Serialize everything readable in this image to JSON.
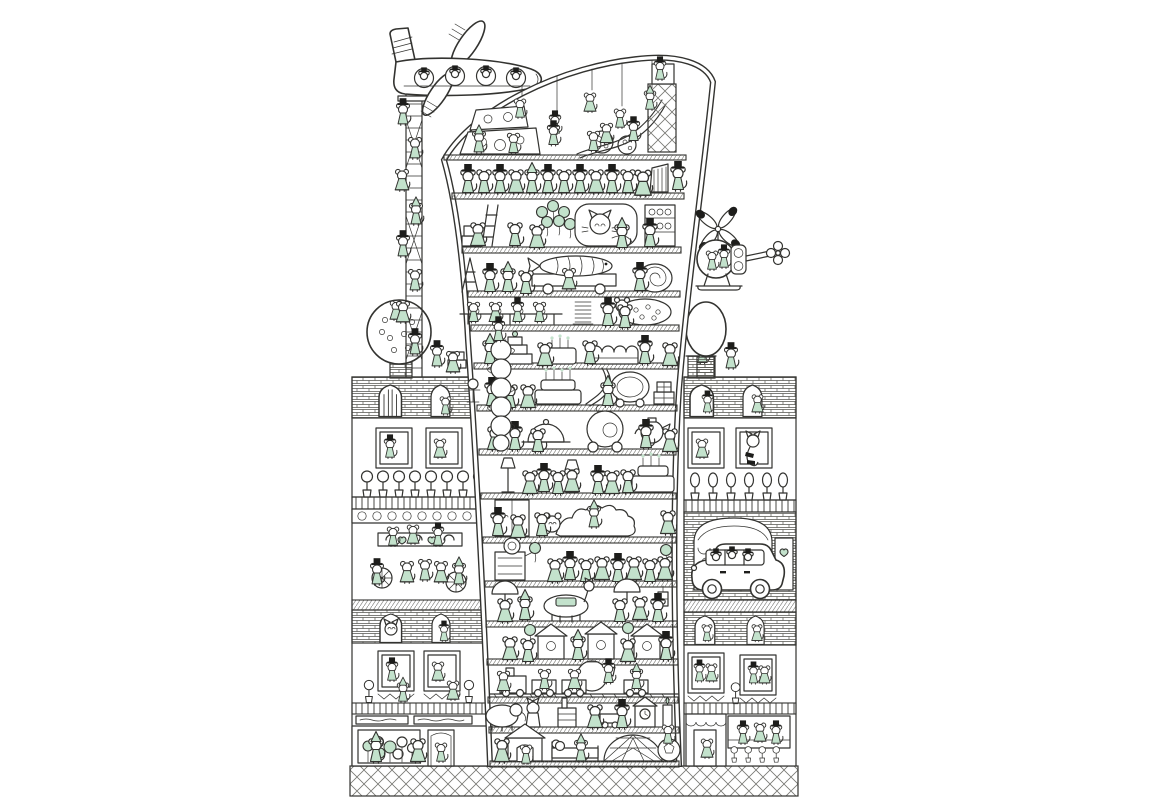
{
  "scene": {
    "description": "Whimsical black-ink illustration with mint green accents: a tall curved tower packed with celebrating mice, flanked by two mouse apartment buildings, an airplane perched on a tall ladder tower, a helicopter, trees, a family car and a crosshatched pavement",
    "style": "hand-drawn pen illustration, white background, mint green accent color"
  },
  "colors": {
    "ink": "#333330",
    "black": "#1d1d1b",
    "mint": "#c3e2cc",
    "mint_deep": "#9fd1b0",
    "paper": "#ffffff",
    "soft": "#8a8a86"
  },
  "elements": {
    "airplane": {
      "label": "airplane full of mice",
      "window_count": 4
    },
    "ladder_tower": {
      "label": "tall ladder tower with climbing mice"
    },
    "main_tower": {
      "label": "curved leaning tower of mice",
      "floor_count": 16
    },
    "helicopter": {
      "label": "helicopter with mouse pilots and flower tail rotor"
    },
    "left_building": {
      "label": "left apartment building with apple tree, cafe terrace and flower shop"
    },
    "right_building": {
      "label": "right apartment building with arched bakery, car and hat shop"
    },
    "car": {
      "label": "white family wagon driven by mice"
    },
    "apple_tree": {
      "label": "round apple tree with mice picking apples"
    },
    "round_tree": {
      "label": "fuzzy topiary tree with top-hat mouse"
    },
    "pavement": {
      "label": "diamond crosshatched pavement"
    }
  },
  "tower_floors": [
    {
      "name": "rooftop-playground",
      "features": [
        "hanging swing mice",
        "cheese-wedge blocks with holes",
        "cheese balls",
        "wavy slide",
        "climbing frame"
      ]
    },
    {
      "name": "choir-floor",
      "features": [
        "row of top-hat mice singing",
        "gown lady mouse",
        "organ pipes",
        "conductor"
      ]
    },
    {
      "name": "cat-lounge-floor",
      "features": [
        "crates",
        "ladder",
        "green balloon bunch",
        "big sleeping cat",
        "plate shelf"
      ]
    },
    {
      "name": "fish-wagon-floor",
      "features": [
        "step ladder",
        "wagon carrying giant fish",
        "snail-roll spiral"
      ]
    },
    {
      "name": "banquet-floor",
      "features": [
        "long table with seated mice",
        "stacked plates",
        "polka-dot pillow mouse"
      ]
    },
    {
      "name": "cake-floor",
      "features": [
        "tiered cake",
        "candle cake",
        "long jelly cake"
      ]
    },
    {
      "name": "party-chute-floor",
      "features": [
        "birthday cake with candles",
        "ribbon chute",
        "ornate carriage frame",
        "presents"
      ]
    },
    {
      "name": "tea-party-floor",
      "features": [
        "dome dish",
        "pumpkin carriage",
        "kettle",
        "stacked teapot column"
      ]
    },
    {
      "name": "lamp-dance-floor",
      "features": [
        "floor lamps",
        "dancing mouse couples",
        "big candle cake"
      ]
    },
    {
      "name": "quilt-floor",
      "features": [
        "wardrobe",
        "long quilted caterpillar blanket"
      ]
    },
    {
      "name": "gramophone-floor",
      "features": [
        "gramophone",
        "row of dancing mice",
        "balloons"
      ]
    },
    {
      "name": "umbrella-floor",
      "features": [
        "umbrella mice",
        "llama with blanket",
        "lantern"
      ]
    },
    {
      "name": "stall-floor",
      "features": [
        "three little stall houses",
        "balloons"
      ]
    },
    {
      "name": "train-floor",
      "features": [
        "toy train with carts of mice",
        "big teapot",
        "track"
      ]
    },
    {
      "name": "toy-floor",
      "features": [
        "elephant toy",
        "standing cat",
        "factory block",
        "cart",
        "clock house",
        "candle"
      ]
    },
    {
      "name": "ground-floor",
      "features": [
        "doghouse with mouse",
        "bed with sleeping mouse",
        "geodesic net tunnel",
        "ball with mouse"
      ]
    }
  ]
}
